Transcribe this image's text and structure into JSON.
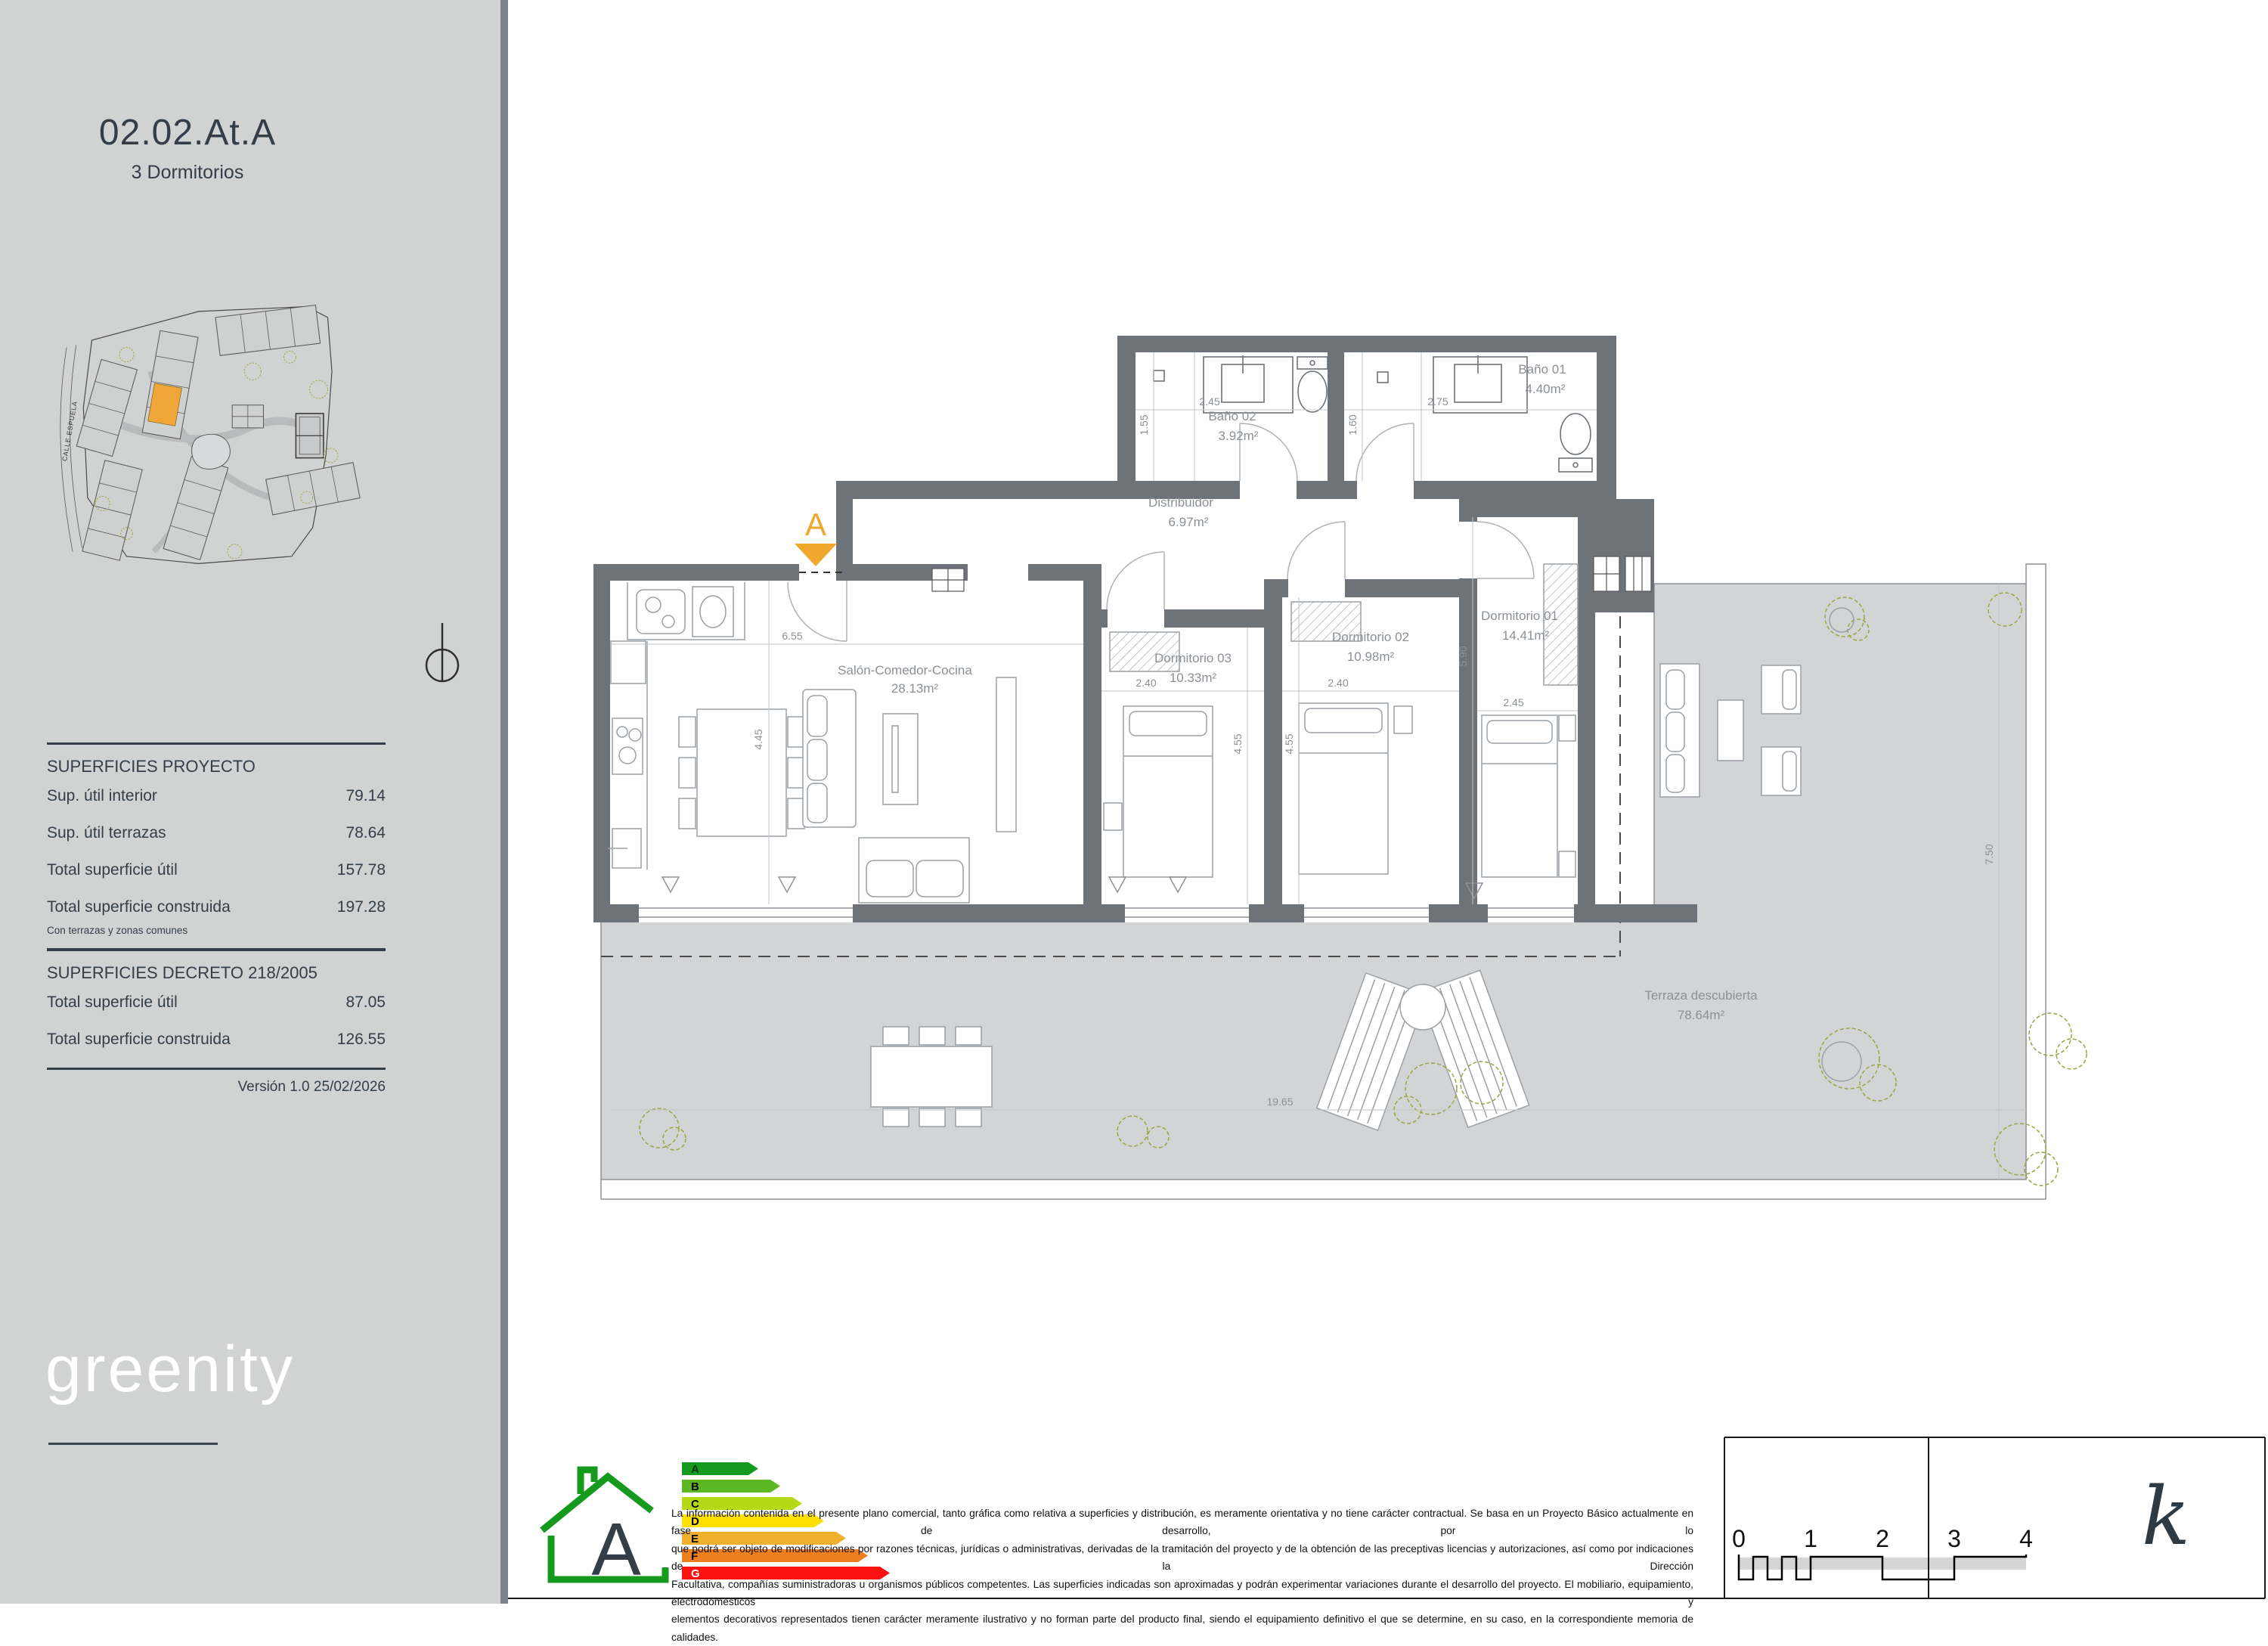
{
  "sidebar": {
    "unit_code": "02.02.At.A",
    "unit_type": "3 Dormitorios",
    "site_map": {
      "street_label": "CALLE ESPUELA"
    },
    "superficies_proyecto": {
      "title": "SUPERFICIES  PROYECTO",
      "rows": [
        {
          "label": "Sup. útil interior",
          "value": "79.14"
        },
        {
          "label": "Sup. útil terrazas",
          "value": "78.64"
        },
        {
          "label": "Total superficie útil",
          "value": "157.78"
        },
        {
          "label": "Total superficie construida",
          "value": "197.28"
        }
      ],
      "note": "Con terrazas y zonas comunes"
    },
    "superficies_decreto": {
      "title": "SUPERFICIES DECRETO 218/2005",
      "rows": [
        {
          "label": "Total superficie útil",
          "value": "87.05"
        },
        {
          "label": "Total superficie construida",
          "value": "126.55"
        }
      ]
    },
    "version": "Versión 1.0 25/02/2026",
    "brand": "greenity"
  },
  "plan": {
    "section_marker": "A",
    "rooms": {
      "salon": {
        "name": "Salón-Comedor-Cocina",
        "area": "28.13m²",
        "dim_w": "6.55",
        "dim_h": "4.45"
      },
      "dormitorio03": {
        "name": "Dormitorio 03",
        "area": "10.33m²",
        "dim_w": "2.40",
        "dim_h": "4.55"
      },
      "dormitorio02": {
        "name": "Dormitorio 02",
        "area": "10.98m²",
        "dim_w": "2.40",
        "dim_h": "4.55"
      },
      "dormitorio01": {
        "name": "Dormitorio 01",
        "area": "14.41m²",
        "dim_w": "2.45",
        "dim_h": "5.90"
      },
      "bano02": {
        "name": "Baño 02",
        "area": "3.92m²",
        "dim_w": "2.45",
        "dim_h": "1.55"
      },
      "bano01": {
        "name": "Baño 01",
        "area": "4.40m²",
        "dim_w": "2.75",
        "dim_h": "1.60"
      },
      "distribuidor": {
        "name": "Distribuidor",
        "area": "6.97m²"
      },
      "terraza": {
        "name": "Terraza descubierta",
        "area": "78.64m²",
        "dim_w": "19.65",
        "dim_h": "7.50"
      }
    }
  },
  "footer": {
    "energy": {
      "rating": "A",
      "letters": [
        "A",
        "B",
        "C",
        "D",
        "E",
        "F",
        "G"
      ]
    },
    "disclaimer_lines": [
      "La información contenida en el presente plano comercial, tanto gráfica como relativa a superficies y distribución, es meramente orientativa y no tiene carácter contractual. Se basa en un Proyecto Básico actualmente en fase de desarrollo, por lo",
      "que podrá ser objeto de modificaciones por razones técnicas, jurídicas o administrativas, derivadas de la tramitación del proyecto y de la obtención de las preceptivas licencias y autorizaciones, así como por indicaciones de la Dirección",
      "Facultativa, compañías suministradoras u organismos públicos competentes. Las superficies indicadas son aproximadas y podrán experimentar variaciones durante el desarrollo del proyecto. El mobiliario, equipamiento, electrodomésticos y",
      "elementos decorativos representados tienen carácter meramente ilustrativo y no forman parte del producto final, siendo el equipamiento definitivo el que se determine, en su caso, en la correspondiente memoria de calidades."
    ],
    "scale_ticks": [
      "0",
      "1",
      "2",
      "3",
      "4"
    ],
    "architect_logo": "k"
  }
}
